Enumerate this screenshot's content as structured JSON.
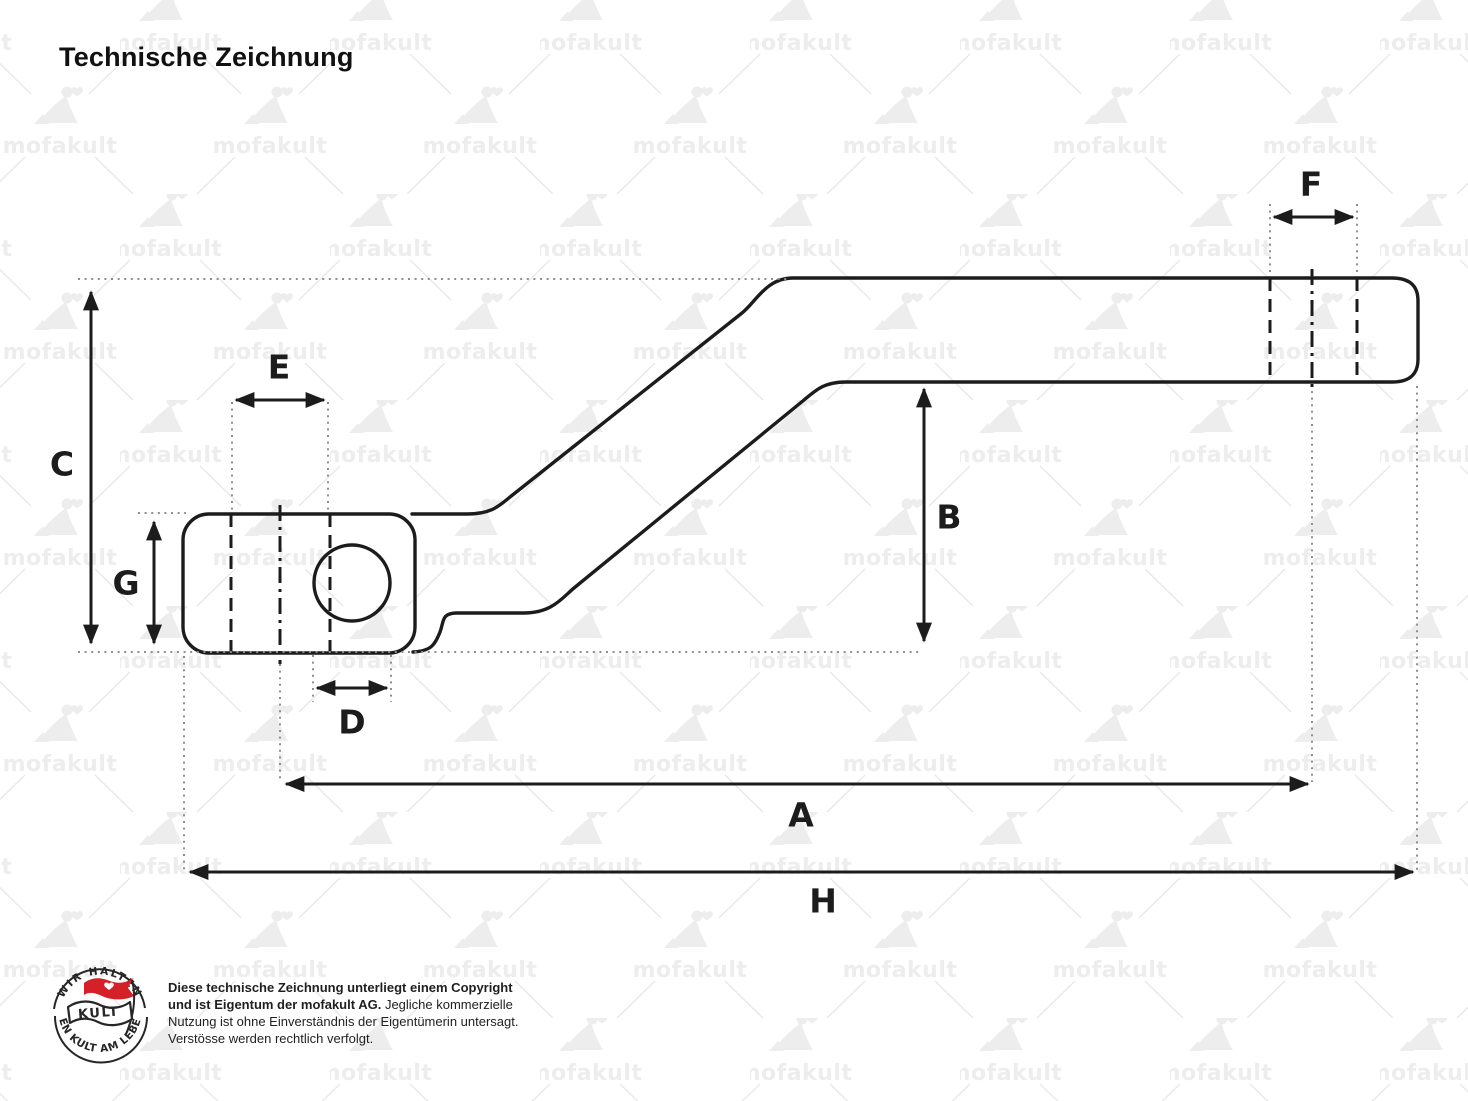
{
  "title": "Technische Zeichnung",
  "watermark": {
    "text": "mofakult"
  },
  "dim_labels": {
    "a": "A",
    "b": "B",
    "c": "C",
    "d": "D",
    "e": "E",
    "f": "F",
    "g": "G",
    "h": "H"
  },
  "badge": {
    "arc_top": "WIR HALTEN",
    "arc_bottom": "DEN KULT AM LEBEN",
    "flag": "KULT"
  },
  "copyright": {
    "bold": "Diese technische Zeichnung unterliegt einem Copyright und ist Eigentum der mofakult AG.",
    "regular": "Jegliche kommerzielle Nutzung ist ohne Einverständnis der Eigentümerin untersagt. Verstösse werden rechtlich verfolgt."
  },
  "colors": {
    "line": "#1c1c1c",
    "leader_dots": "#8e8e8e",
    "watermark": "#ededed",
    "badge_red": "#d42027"
  }
}
